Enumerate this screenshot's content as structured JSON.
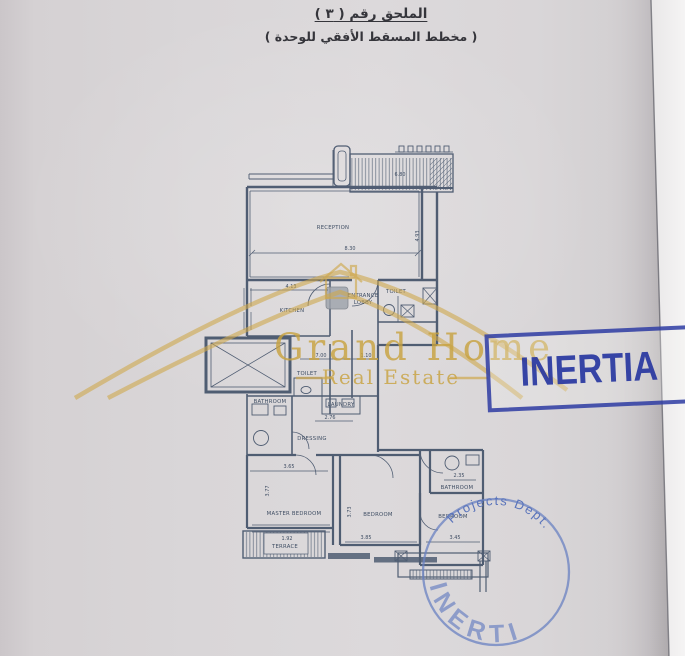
{
  "header": {
    "title_line1": "الملحق رقم ( ٣ )",
    "title_line2": "( مخطط المسقط الأفقي للوحدة )"
  },
  "watermark": {
    "name": "Grand Home",
    "tagline": "Real Estate"
  },
  "stamps": {
    "rect_stamp": {
      "label": "INERTIA"
    },
    "round_stamp": {
      "top_text": "Projects Dept.",
      "bottom_text": "INERTIA"
    }
  },
  "plan": {
    "labels": {
      "reception": "RECEPTION",
      "kitchen": "KITCHEN",
      "entrance_line1": "ENTRANCE",
      "entrance_line2": "LOBBY",
      "toilet_top": "TOILET",
      "bathroom_left": "BATHROOM",
      "toilet_mid": "TOILET",
      "laundry": "LAUNDRY",
      "dressing": "DRESSING",
      "master_bedroom": "MASTER BEDROOM",
      "bedroom_mid": "BEDROOM",
      "bedroom_right": "BEDROOM",
      "bathroom_right": "BATHROOM",
      "terrace": "TERRACE"
    },
    "dimensions": {
      "reception_width": "8.30",
      "reception_depth": "4.93",
      "pergola_width": "6.80",
      "kitchen_width": "4.13",
      "hall_width": "7.00",
      "hall_minor": "1.10",
      "dressing_width": "2.76",
      "master_width": "3.65",
      "master_depth": "3.77",
      "bedroom_mid_width": "3.85",
      "bedroom_mid_depth": "3.73",
      "bedroom_right_width": "3.45",
      "bathroom_right_width": "2.35",
      "terrace_width": "1.92"
    }
  },
  "colors": {
    "plan_ink": "#44536a",
    "stamp_blue": "#2635a0",
    "round_stamp_blue": "#5f79c0",
    "watermark_gold": "#c8a23e",
    "paper": "#dcd9db"
  }
}
